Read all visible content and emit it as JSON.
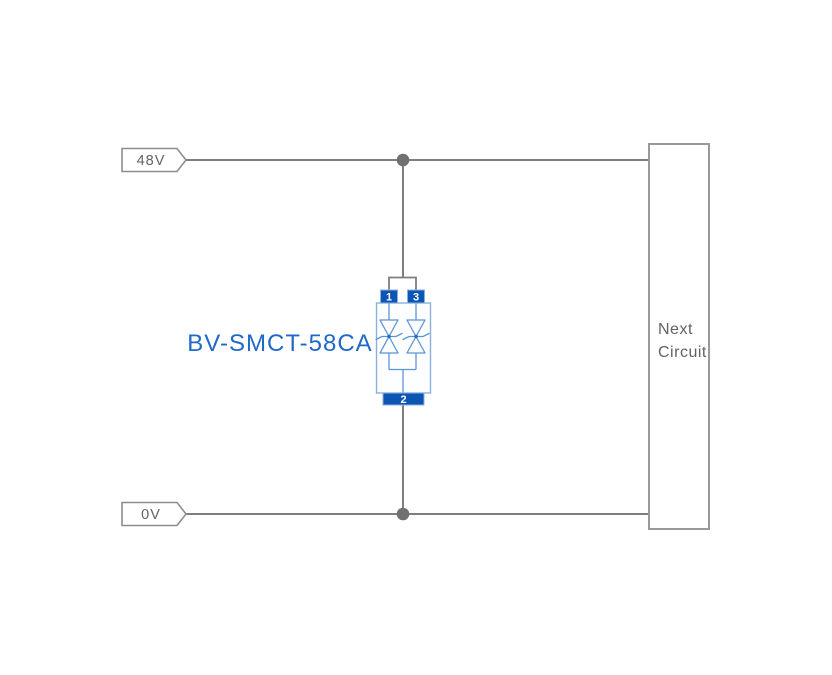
{
  "colors": {
    "wire-gray": "#7e7e7e",
    "dot-gray": "#707070",
    "tag-gray": "#8d8d8d",
    "box-gray": "#999999",
    "text-gray": "#636363",
    "part-blue": "#2068c9",
    "pin-blue": "#0d55b3",
    "light-blue": "#8cb0de",
    "diode-blue": "#5e95d6"
  },
  "diagram": {
    "part_number": "BV-SMCT-58CA",
    "rail_top_label": "48V",
    "rail_bottom_label": "0V",
    "next_box": {
      "line1": "Next",
      "line2": "Circuit"
    },
    "pins": {
      "p1": "1",
      "p2": "2",
      "p3": "3"
    }
  }
}
